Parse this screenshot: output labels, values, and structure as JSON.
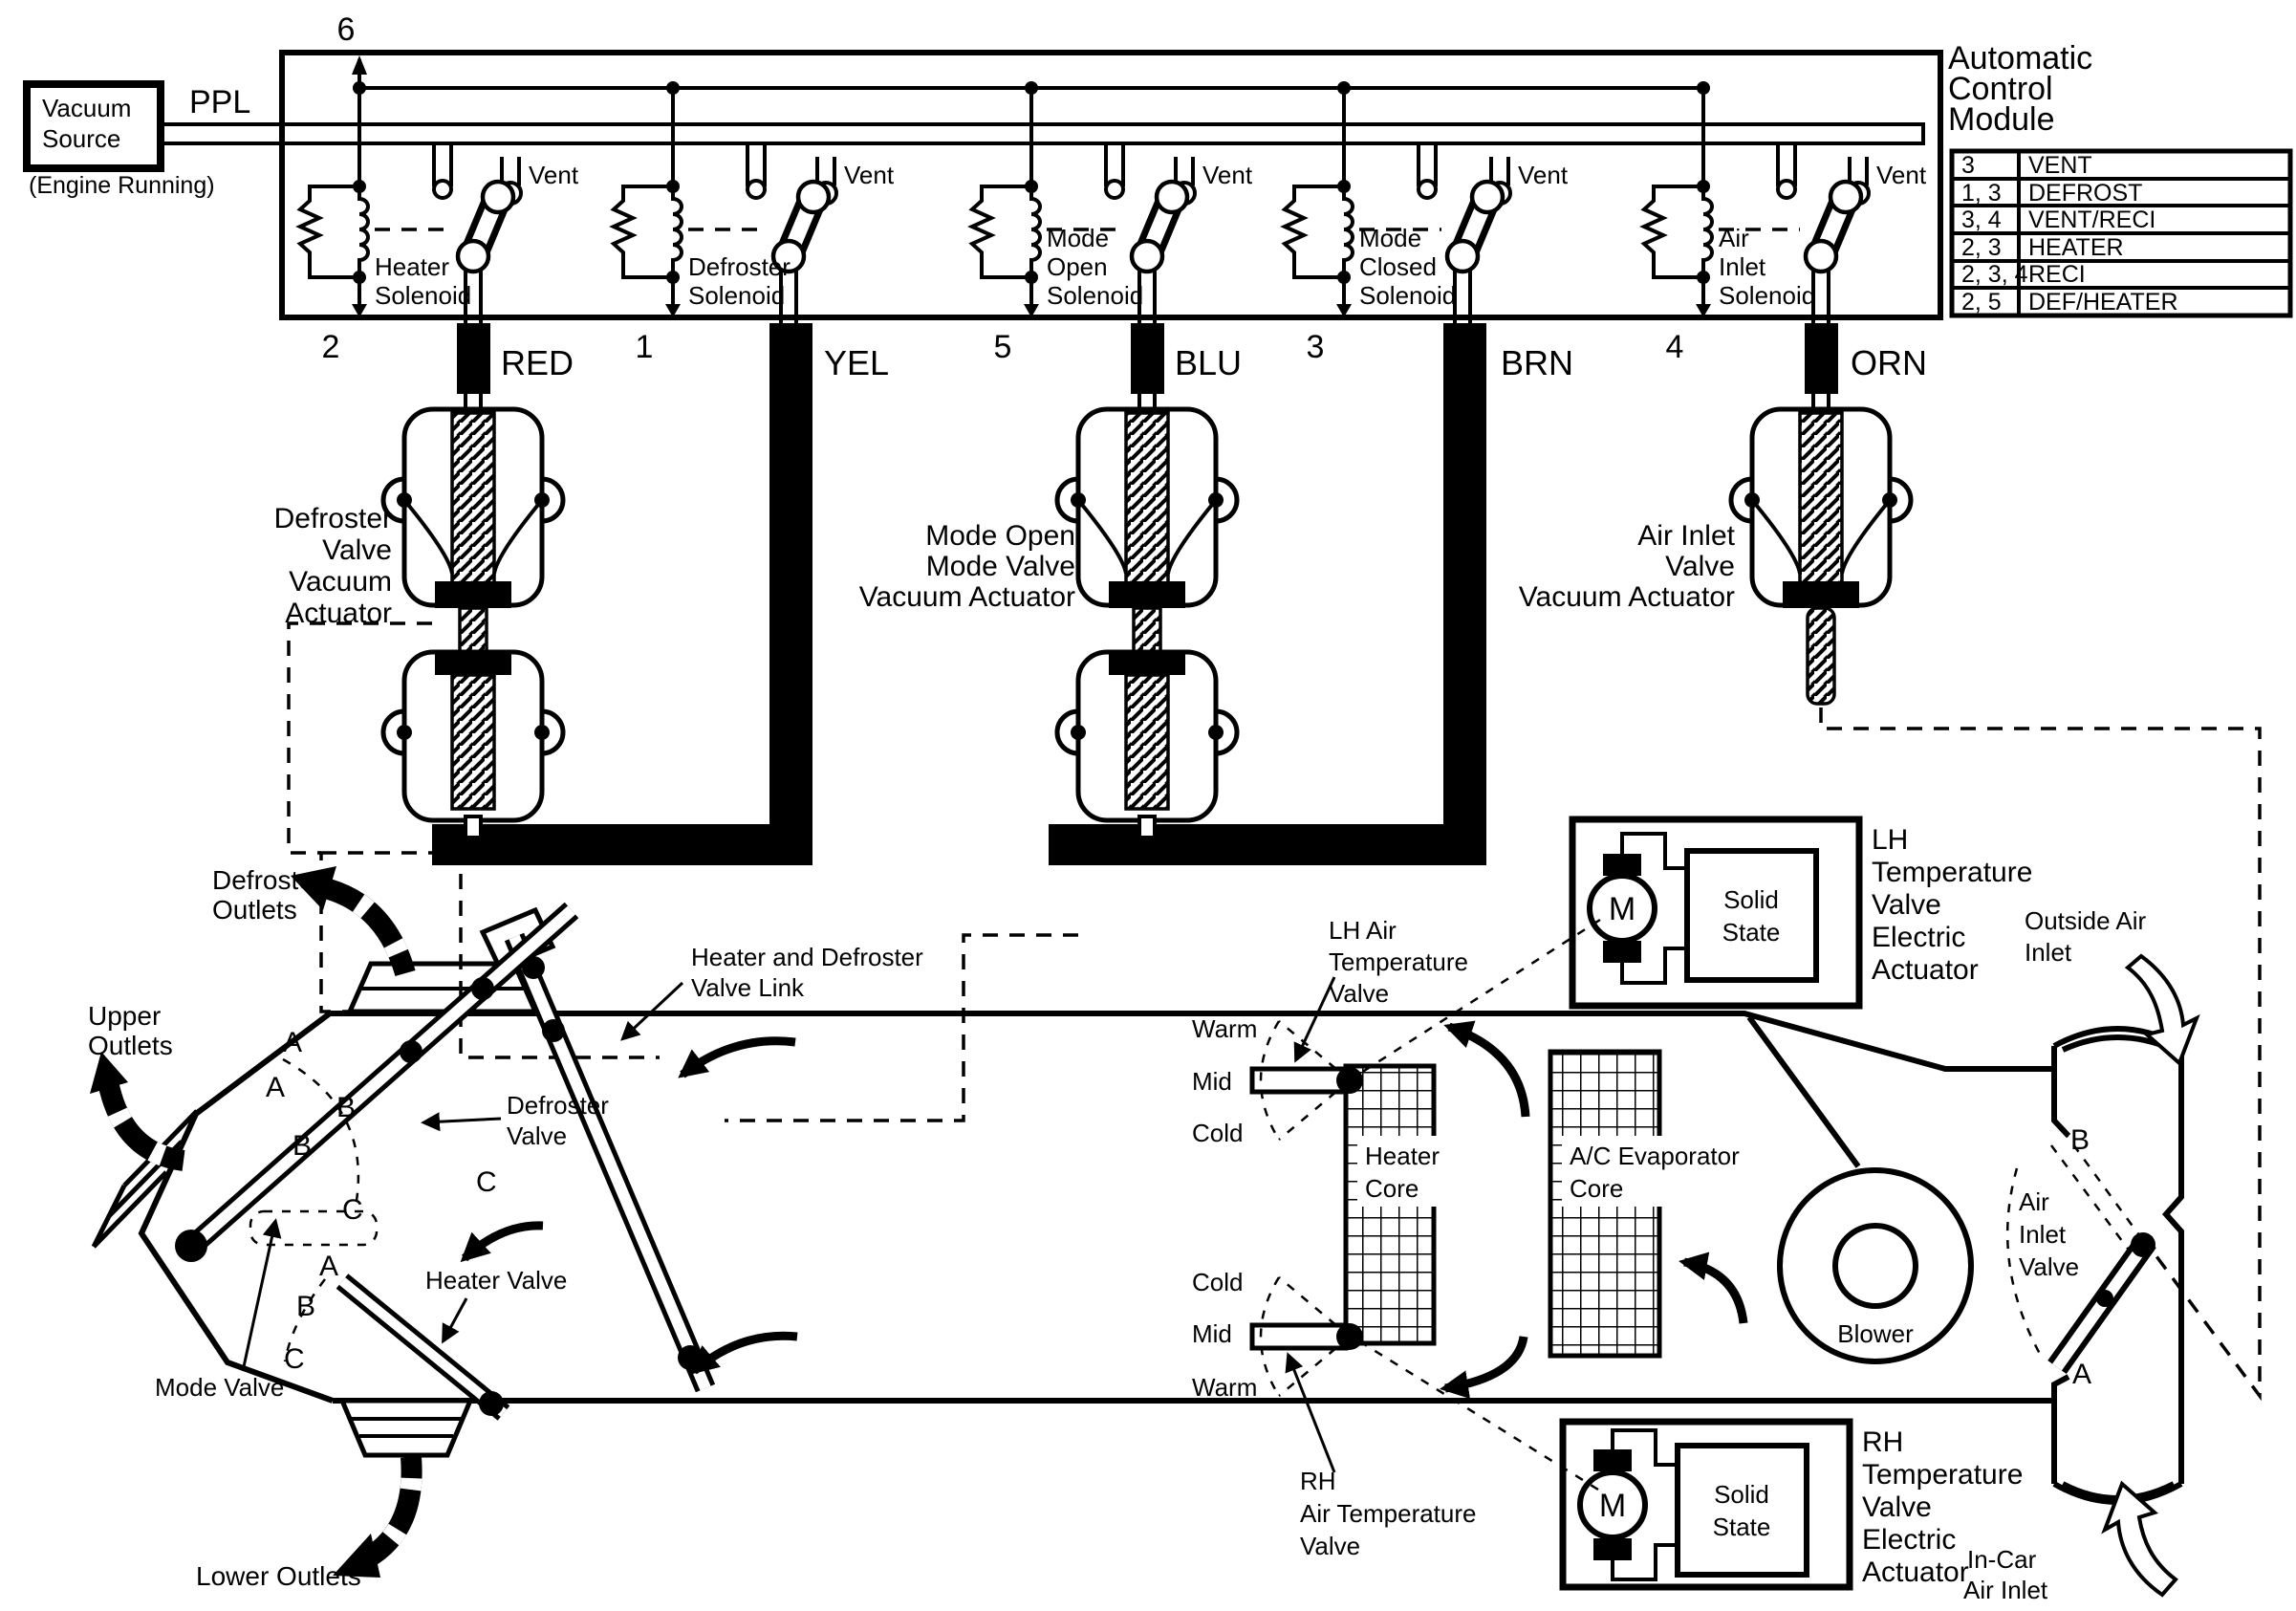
{
  "source": {
    "line1": "Vacuum",
    "line2": "Source",
    "note": "(Engine Running)",
    "wire": "PPL"
  },
  "module": {
    "pin_top": "6",
    "title": [
      "Automatic",
      "Control",
      "Module"
    ],
    "table": [
      {
        "pins": "3",
        "mode": "VENT"
      },
      {
        "pins": "1, 3",
        "mode": "DEFROST"
      },
      {
        "pins": "3, 4",
        "mode": "VENT/RECI"
      },
      {
        "pins": "2, 3",
        "mode": "HEATER"
      },
      {
        "pins": "2, 3, 4",
        "mode": "RECI"
      },
      {
        "pins": "2, 5",
        "mode": "DEF/HEATER"
      }
    ],
    "solenoids": [
      {
        "lines": [
          "Heater",
          "Solenoid"
        ],
        "pin": "2",
        "wire": "RED",
        "vent": "Vent"
      },
      {
        "lines": [
          "Defroster",
          "Solenoid"
        ],
        "pin": "1",
        "wire": "YEL",
        "vent": "Vent"
      },
      {
        "lines": [
          "Mode",
          "Open",
          "Solenoid"
        ],
        "pin": "5",
        "wire": "BLU",
        "vent": "Vent"
      },
      {
        "lines": [
          "Mode",
          "Closed",
          "Solenoid"
        ],
        "pin": "3",
        "wire": "BRN",
        "vent": "Vent"
      },
      {
        "lines": [
          "Air",
          "Inlet",
          "Solenoid"
        ],
        "pin": "4",
        "wire": "ORN",
        "vent": "Vent"
      }
    ]
  },
  "actuators": {
    "defroster": [
      "Defroster",
      "Valve",
      "Vacuum",
      "Actuator"
    ],
    "mode": [
      "Mode Open",
      "Mode Valve",
      "Vacuum Actuator"
    ],
    "air_inlet": [
      "Air Inlet",
      "Valve",
      "Vacuum Actuator"
    ]
  },
  "electric": {
    "lh": {
      "label": [
        "LH",
        "Temperature",
        "Valve",
        "Electric",
        "Actuator"
      ],
      "motor": "M",
      "solid": [
        "Solid",
        "State"
      ]
    },
    "rh": {
      "label": [
        "RH",
        "Temperature",
        "Valve",
        "Electric",
        "Actuator"
      ],
      "motor": "M",
      "solid": [
        "Solid",
        "State"
      ]
    }
  },
  "hvac": {
    "defroster_outlets": [
      "Defroster",
      "Outlets"
    ],
    "upper_outlets": [
      "Upper",
      "Outlets"
    ],
    "lower_outlets": "Lower Outlets",
    "link": [
      "Heater and Defroster",
      "Valve Link"
    ],
    "defroster_valve": [
      "Defroster",
      "Valve"
    ],
    "heater_valve": "Heater Valve",
    "mode_valve": "Mode Valve",
    "lh_valve": [
      "LH Air",
      "Temperature",
      "Valve"
    ],
    "rh_valve": [
      "RH",
      "Air Temperature",
      "Valve"
    ],
    "lh_temps": [
      "Warm",
      "Mid",
      "Cold"
    ],
    "rh_temps": [
      "Cold",
      "Mid",
      "Warm"
    ],
    "heater_core": [
      "Heater",
      "Core"
    ],
    "evap_core": [
      "A/C Evaporator",
      "Core"
    ],
    "blower": "Blower",
    "air_inlet_valve": [
      "Air",
      "Inlet",
      "Valve"
    ],
    "outside_air": [
      "Outside Air",
      "Inlet"
    ],
    "in_car_air": [
      "In-Car",
      "Air Inlet"
    ],
    "pos_a": "A",
    "pos_b": "B",
    "pos_c": "C"
  }
}
